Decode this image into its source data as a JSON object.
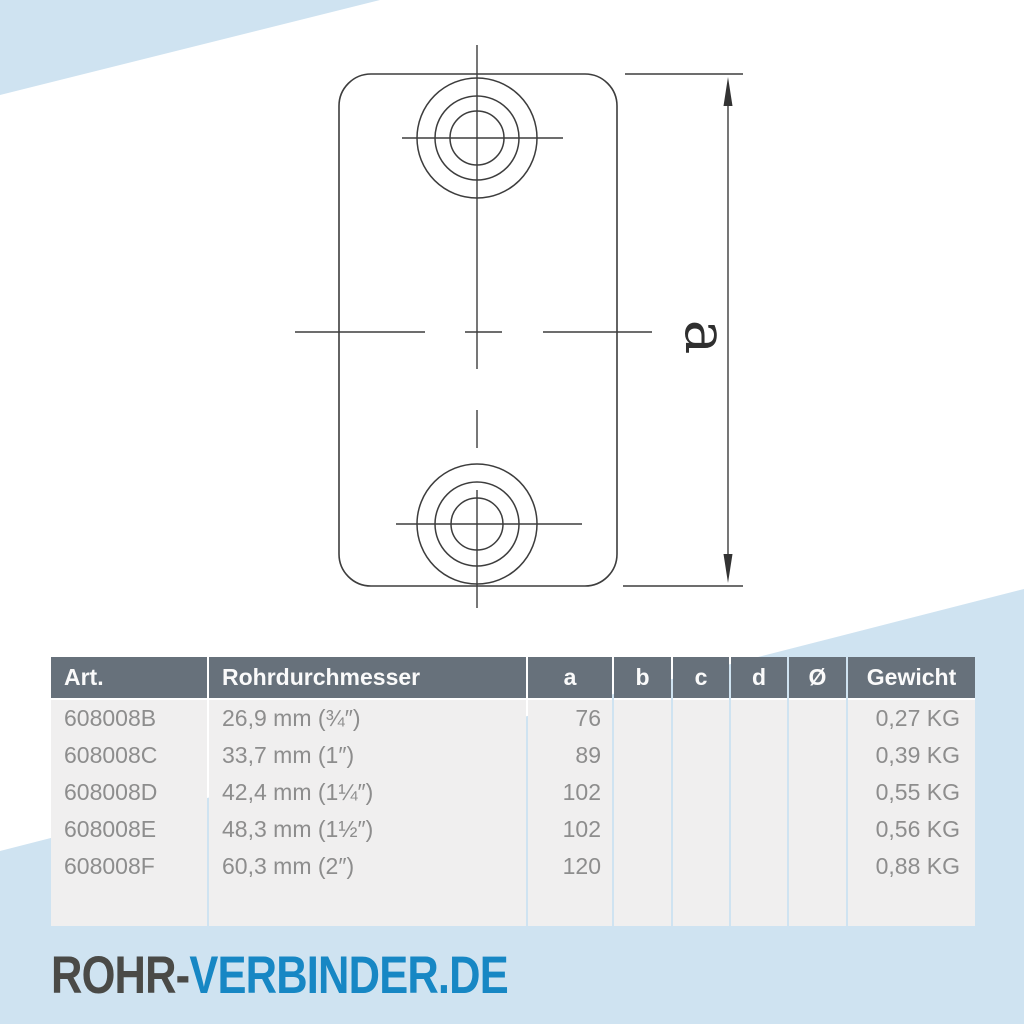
{
  "drawing": {
    "dimension_label": "a",
    "description": "top view of rectangular connector plate with two concentric bolt holes and vertical dimension a"
  },
  "table": {
    "headers": [
      "Art.",
      "Rohrdurchmesser",
      "a",
      "b",
      "c",
      "d",
      "Ø",
      "Gewicht"
    ],
    "rows": [
      {
        "art": "608008B",
        "diameter": "26,9 mm (¾″)",
        "a": "76",
        "b": "",
        "c": "",
        "d": "",
        "dia": "",
        "gewicht": "0,27 KG"
      },
      {
        "art": "608008C",
        "diameter": "33,7 mm (1″)",
        "a": "89",
        "b": "",
        "c": "",
        "d": "",
        "dia": "",
        "gewicht": "0,39 KG"
      },
      {
        "art": "608008D",
        "diameter": "42,4 mm (1¼″)",
        "a": "102",
        "b": "",
        "c": "",
        "d": "",
        "dia": "",
        "gewicht": "0,55 KG"
      },
      {
        "art": "608008E",
        "diameter": "48,3 mm (1½″)",
        "a": "102",
        "b": "",
        "c": "",
        "d": "",
        "dia": "",
        "gewicht": "0,56 KG"
      },
      {
        "art": "608008F",
        "diameter": "60,3 mm (2″)",
        "a": "120",
        "b": "",
        "c": "",
        "d": "",
        "dia": "",
        "gewicht": "0,88 KG"
      }
    ]
  },
  "logo": {
    "part1": "ROHR-",
    "part2": "VERBINDER.DE"
  },
  "colors": {
    "accent_blue": "#1787c4",
    "light_blue": "#cfe3f1",
    "table_header_bg": "#67717b",
    "table_row_bg": "#f0efef",
    "table_text": "#8d8d8d",
    "drawing_line": "#3d3d3d",
    "logo_dark": "#4a4a47"
  }
}
